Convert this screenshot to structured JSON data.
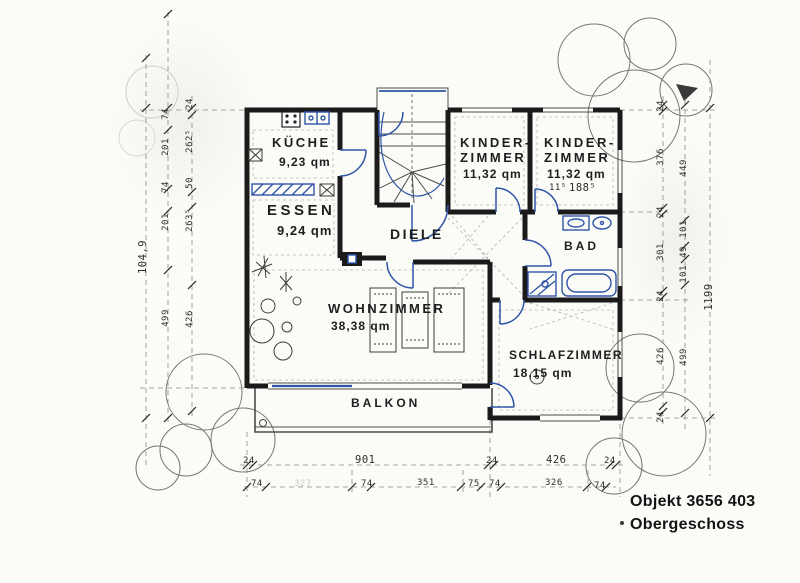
{
  "plan": {
    "rooms": {
      "kueche": {
        "name": "KÜCHE",
        "area": "9,23 qm"
      },
      "essen": {
        "name": "ESSEN",
        "area": "9,24 qm"
      },
      "kinderzimmer1": {
        "name": "KINDER-\nZIMMER",
        "area": "11,32 qm"
      },
      "kinderzimmer2": {
        "name": "KINDER-\nZIMMER",
        "area": "11,32 qm"
      },
      "diele": {
        "name": "DIELE"
      },
      "bad": {
        "name": "BAD"
      },
      "wohnzimmer": {
        "name": "WOHNZIMMER",
        "area": "38,38 qm"
      },
      "schlafzimmer": {
        "name": "SCHLAFZIMMER",
        "area": "18,15 qm"
      },
      "balkon": {
        "name": "BALKON"
      }
    },
    "dims": {
      "bottom_outer": [
        "24",
        "901",
        "24",
        "426",
        "24"
      ],
      "bottom_inner": [
        "74",
        "327",
        "74",
        "351",
        "75",
        "74",
        "326",
        "74"
      ],
      "left_total": "104,9",
      "left_mid": [
        "74",
        "201",
        "74",
        "201",
        "499"
      ],
      "left_inner": [
        "24",
        "262⁵",
        "50",
        "263⁵",
        "426"
      ],
      "right_total": "1199",
      "right_mid": [
        "449",
        "101",
        "49",
        "101",
        "499"
      ],
      "right_inner": [
        "24",
        "376",
        "24",
        "301",
        "24",
        "426",
        "24"
      ],
      "interior": [
        "11⁵",
        "188⁵"
      ]
    },
    "footer": {
      "object": "Objekt 3656 403",
      "floor": "Obergeschoss"
    },
    "colors": {
      "ink": "#1a1a1a",
      "blue": "#2f55a8",
      "paper": "#fbfbf8"
    }
  }
}
